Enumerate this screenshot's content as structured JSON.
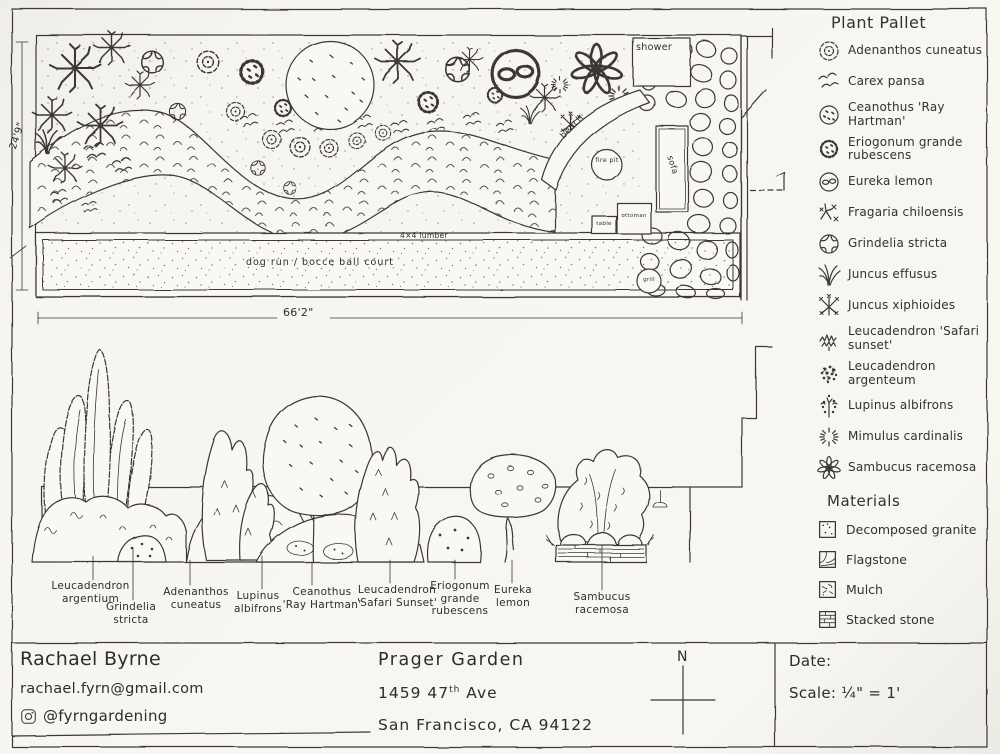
{
  "document": {
    "type": "hand-drawn landscape design sheet",
    "ink_color": "#3a3834",
    "paper_color": "#f6f4ef"
  },
  "plan": {
    "labels": {
      "shower": "shower",
      "bench": "bench",
      "fire_pit": "fire pit",
      "sofa": "sofa",
      "table": "table",
      "ottoman": "ottoman",
      "grill": "grill",
      "lumber": "4×4 lumber",
      "dog_run": "dog run / bocce ball court"
    },
    "dimensions": {
      "height": "24'9\"",
      "width": "66'2\""
    }
  },
  "elevation": {
    "labels": [
      "Leucadendron\nargentium",
      "Grindelia\nstricta",
      "Adenanthos\ncuneatus",
      "Lupinus\nalbifrons",
      "Ceanothus\n'Ray Hartman'",
      "Leucadendron\n'Safari Sunset'",
      "Eriogonum\ngrande\nrubescens",
      "Eureka\nlemon",
      "Sambucus\nracemosa"
    ]
  },
  "legend": {
    "title": "Plant Pallet",
    "items": [
      {
        "icon": "scalloped-circle-icon",
        "label": "Adenanthos cuneatus"
      },
      {
        "icon": "wavy-grass-icon",
        "label": "Carex pansa"
      },
      {
        "icon": "dotted-circle-icon",
        "label": "Ceanothus 'Ray Hartman'"
      },
      {
        "icon": "spiky-dotted-circle-icon",
        "label": "Eriogonum grande rubescens"
      },
      {
        "icon": "fruit-circle-icon",
        "label": "Eureka lemon"
      },
      {
        "icon": "runner-sprig-icon",
        "label": "Fragaria chiloensis"
      },
      {
        "icon": "pinwheel-circle-icon",
        "label": "Grindelia stricta"
      },
      {
        "icon": "grass-fan-icon",
        "label": "Juncus effusus"
      },
      {
        "icon": "starburst-x-icon",
        "label": "Juncus xiphioides"
      },
      {
        "icon": "zigzag-scribble-icon",
        "label": "Leucadendron 'Safari sunset'"
      },
      {
        "icon": "dense-cluster-icon",
        "label": "Leucadendron argenteum"
      },
      {
        "icon": "dotted-stem-icon",
        "label": "Lupinus albifrons"
      },
      {
        "icon": "radiating-dashes-icon",
        "label": "Mimulus cardinalis"
      },
      {
        "icon": "petal-flower-icon",
        "label": "Sambucus racemosa"
      }
    ],
    "materials_title": "Materials",
    "materials": [
      {
        "icon": "dotted-square-icon",
        "label": "Decomposed granite"
      },
      {
        "icon": "flagstone-square-icon",
        "label": "Flagstone"
      },
      {
        "icon": "mulch-square-icon",
        "label": "Mulch"
      },
      {
        "icon": "stacked-lines-square-icon",
        "label": "Stacked stone"
      }
    ]
  },
  "footer": {
    "designer": "Rachael Byrne",
    "email": "rachael.fyrn@gmail.com",
    "instagram": "@fyrngardening",
    "project": "Prager Garden",
    "address_num": "1459  47",
    "address_sup": "th",
    "address_rest": " Ave",
    "address_city": "San Francisco, CA 94122",
    "north": "N",
    "date_label": "Date:",
    "scale_label": "Scale: ¼\" = 1'"
  }
}
